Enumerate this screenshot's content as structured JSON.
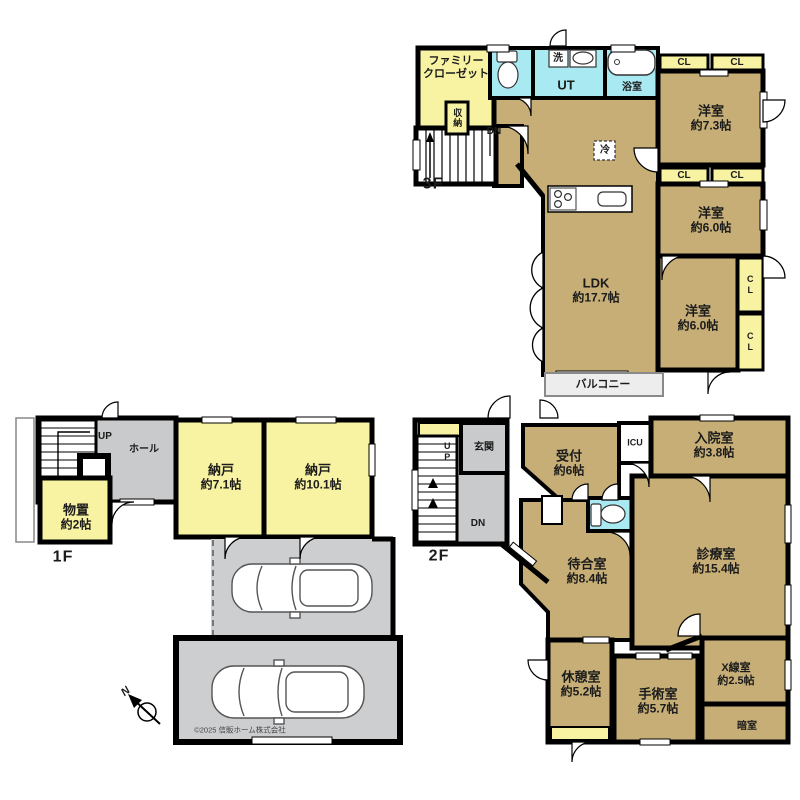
{
  "colors": {
    "wall": "#000000",
    "room_tan": "#c6ae76",
    "closet_yellow": "#f8f3a2",
    "wet_cyan": "#a9e9f2",
    "hall_gray": "#c9cacb",
    "carport_gray": "#cdced0"
  },
  "f3": {
    "floor_label": "3F",
    "family_closet": "ファミリー\nクローゼット",
    "washer": "洗",
    "ut": "UT",
    "bath": "浴室",
    "fridge": "冷",
    "storage": "収納",
    "dn": "DN",
    "cl": "CL",
    "balcony": "バルコニー",
    "rooms": [
      {
        "name": "洋室",
        "size": "約7.3帖"
      },
      {
        "name": "洋室",
        "size": "約6.0帖"
      },
      {
        "name": "洋室",
        "size": "約6.0帖"
      },
      {
        "name": "LDK",
        "size": "約17.7帖"
      }
    ]
  },
  "f1": {
    "floor_label": "1F",
    "up": "UP",
    "hall": "ホール",
    "compass_n": "N",
    "copyright": "©2025 信販ホーム株式会社",
    "rooms": [
      {
        "name": "納戸",
        "size": "約7.1帖"
      },
      {
        "name": "納戸",
        "size": "約10.1帖"
      },
      {
        "name": "物置",
        "size": "約2帖"
      }
    ]
  },
  "f2": {
    "floor_label": "2F",
    "up": "UP",
    "dn": "DN",
    "genkan": "玄関",
    "icu": "ICU",
    "darkroom": "暗室",
    "rooms": [
      {
        "name": "受付",
        "size": "約6帖"
      },
      {
        "name": "入院室",
        "size": "約3.8帖"
      },
      {
        "name": "診療室",
        "size": "約15.4帖"
      },
      {
        "name": "待合室",
        "size": "約8.4帖"
      },
      {
        "name": "休憩室",
        "size": "約5.2帖"
      },
      {
        "name": "手術室",
        "size": "約5.7帖"
      },
      {
        "name": "X線室",
        "size": "約2.5帖"
      }
    ]
  }
}
